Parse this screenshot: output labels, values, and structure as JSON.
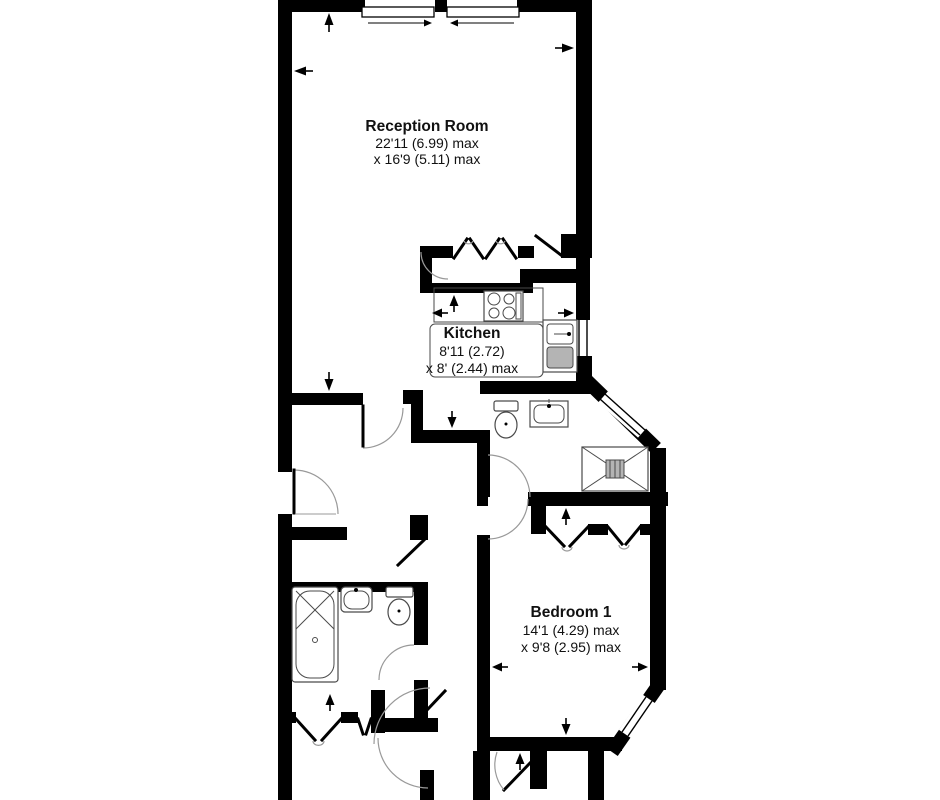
{
  "plan": {
    "type": "floorplan",
    "colors": {
      "wall": "#000000",
      "door_arc": "#999999",
      "fixture_outline": "#4a4a4a",
      "fixture_gray": "#b4b4b4",
      "background": "#ffffff",
      "text": "#111111"
    },
    "rooms": [
      {
        "id": "reception",
        "name": "Reception Room",
        "dim1": "22'11 (6.99) max",
        "dim2": "x 16'9 (5.11) max"
      },
      {
        "id": "kitchen",
        "name": "Kitchen",
        "dim1": "8'11 (2.72)",
        "dim2": "x 8' (2.44) max"
      },
      {
        "id": "bedroom1",
        "name": "Bedroom 1",
        "dim1": "14'1 (4.29) max",
        "dim2": "x 9'8 (2.95) max"
      }
    ],
    "fixtures": {
      "kitchen": [
        "hob",
        "sink-and-drainer"
      ],
      "shower_room": [
        "toilet",
        "wash-basin",
        "shower-tray"
      ],
      "bathroom": [
        "bathtub",
        "wash-basin",
        "toilet"
      ]
    },
    "features": [
      "sliding-windows",
      "french-doors",
      "bifold-wardrobe-doors",
      "bay-window",
      "measurement-arrows"
    ]
  }
}
